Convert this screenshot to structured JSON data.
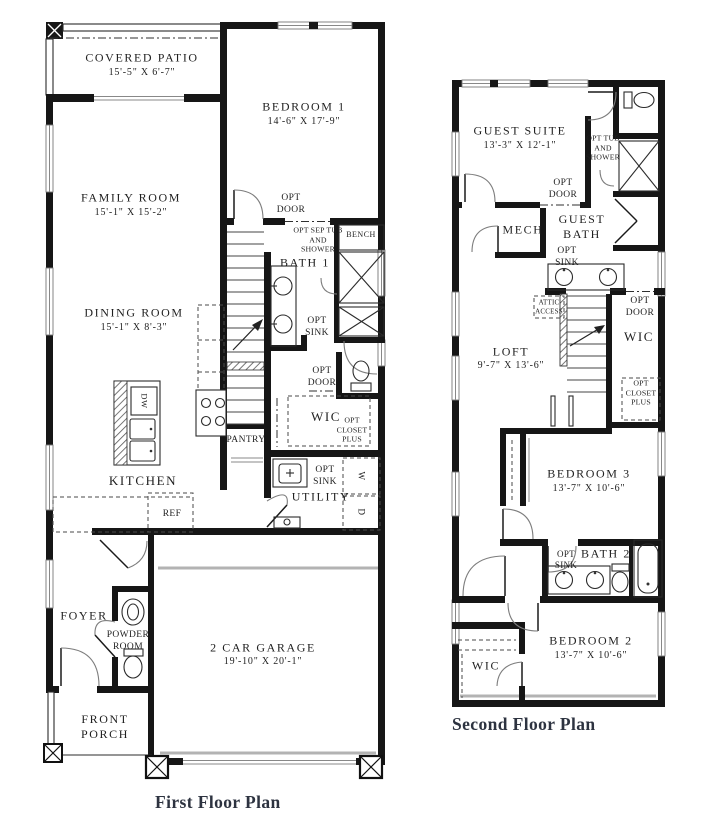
{
  "first_floor": {
    "title": "First Floor Plan",
    "rooms": {
      "covered_patio": {
        "name": "COVERED PATIO",
        "dims": "15'-5\" X 6'-7\""
      },
      "bedroom_1": {
        "name": "BEDROOM 1",
        "dims": "14'-6\" X 17'-9\""
      },
      "family_room": {
        "name": "FAMILY ROOM",
        "dims": "15'-1\" X 15'-2\""
      },
      "dining_room": {
        "name": "DINING ROOM",
        "dims": "15'-1\" X 8'-3\""
      },
      "kitchen": {
        "name": "KITCHEN"
      },
      "bath_1": {
        "name": "BATH 1"
      },
      "wic": {
        "name": "WIC"
      },
      "utility": {
        "name": "UTILITY"
      },
      "foyer": {
        "name": "FOYER"
      },
      "powder_room": {
        "name": "POWDER ROOM"
      },
      "front_porch": {
        "name": "FRONT PORCH"
      },
      "garage": {
        "name": "2 CAR GARAGE",
        "dims": "19'-10\" X 20'-1\""
      }
    },
    "labels": {
      "opt_door_bedroom": "OPT DOOR",
      "opt_sep_tub_shower": "OPT SEP TUB AND SHOWER",
      "bench": "BENCH",
      "opt_sink_bath": "OPT SINK",
      "opt_door_wic": "OPT DOOR",
      "opt_closet_plus": "OPT CLOSET PLUS",
      "pantry": "PANTRY",
      "refrigerator": "REF",
      "dishwasher": "DW",
      "opt_sink_utility": "OPT SINK",
      "washer": "W",
      "dryer": "D"
    }
  },
  "second_floor": {
    "title": "Second Floor Plan",
    "rooms": {
      "guest_suite": {
        "name": "GUEST SUITE",
        "dims": "13'-3\" X 12'-1\""
      },
      "guest_bath": {
        "name": "GUEST BATH"
      },
      "mech": {
        "name": "MECH"
      },
      "loft": {
        "name": "LOFT",
        "dims": "9'-7\" X 13'-6\""
      },
      "wic": {
        "name": "WIC"
      },
      "bedroom_3": {
        "name": "BEDROOM 3",
        "dims": "13'-7\" X 10'-6\""
      },
      "bath_2": {
        "name": "BATH 2"
      },
      "bedroom_2": {
        "name": "BEDROOM 2",
        "dims": "13'-7\" X 10'-6\""
      },
      "wic_bedroom_2": {
        "name": "WIC"
      }
    },
    "labels": {
      "opt_tub_and_shower": "OPT TUB AND SHOWER",
      "opt_door_guest": "OPT DOOR",
      "opt_sink_guest": "OPT SINK",
      "attic_access": "ATTIC ACCESS",
      "opt_door_wic": "OPT DOOR",
      "opt_closet_plus": "OPT CLOSET PLUS",
      "opt_sink_bath2": "OPT SINK"
    }
  }
}
